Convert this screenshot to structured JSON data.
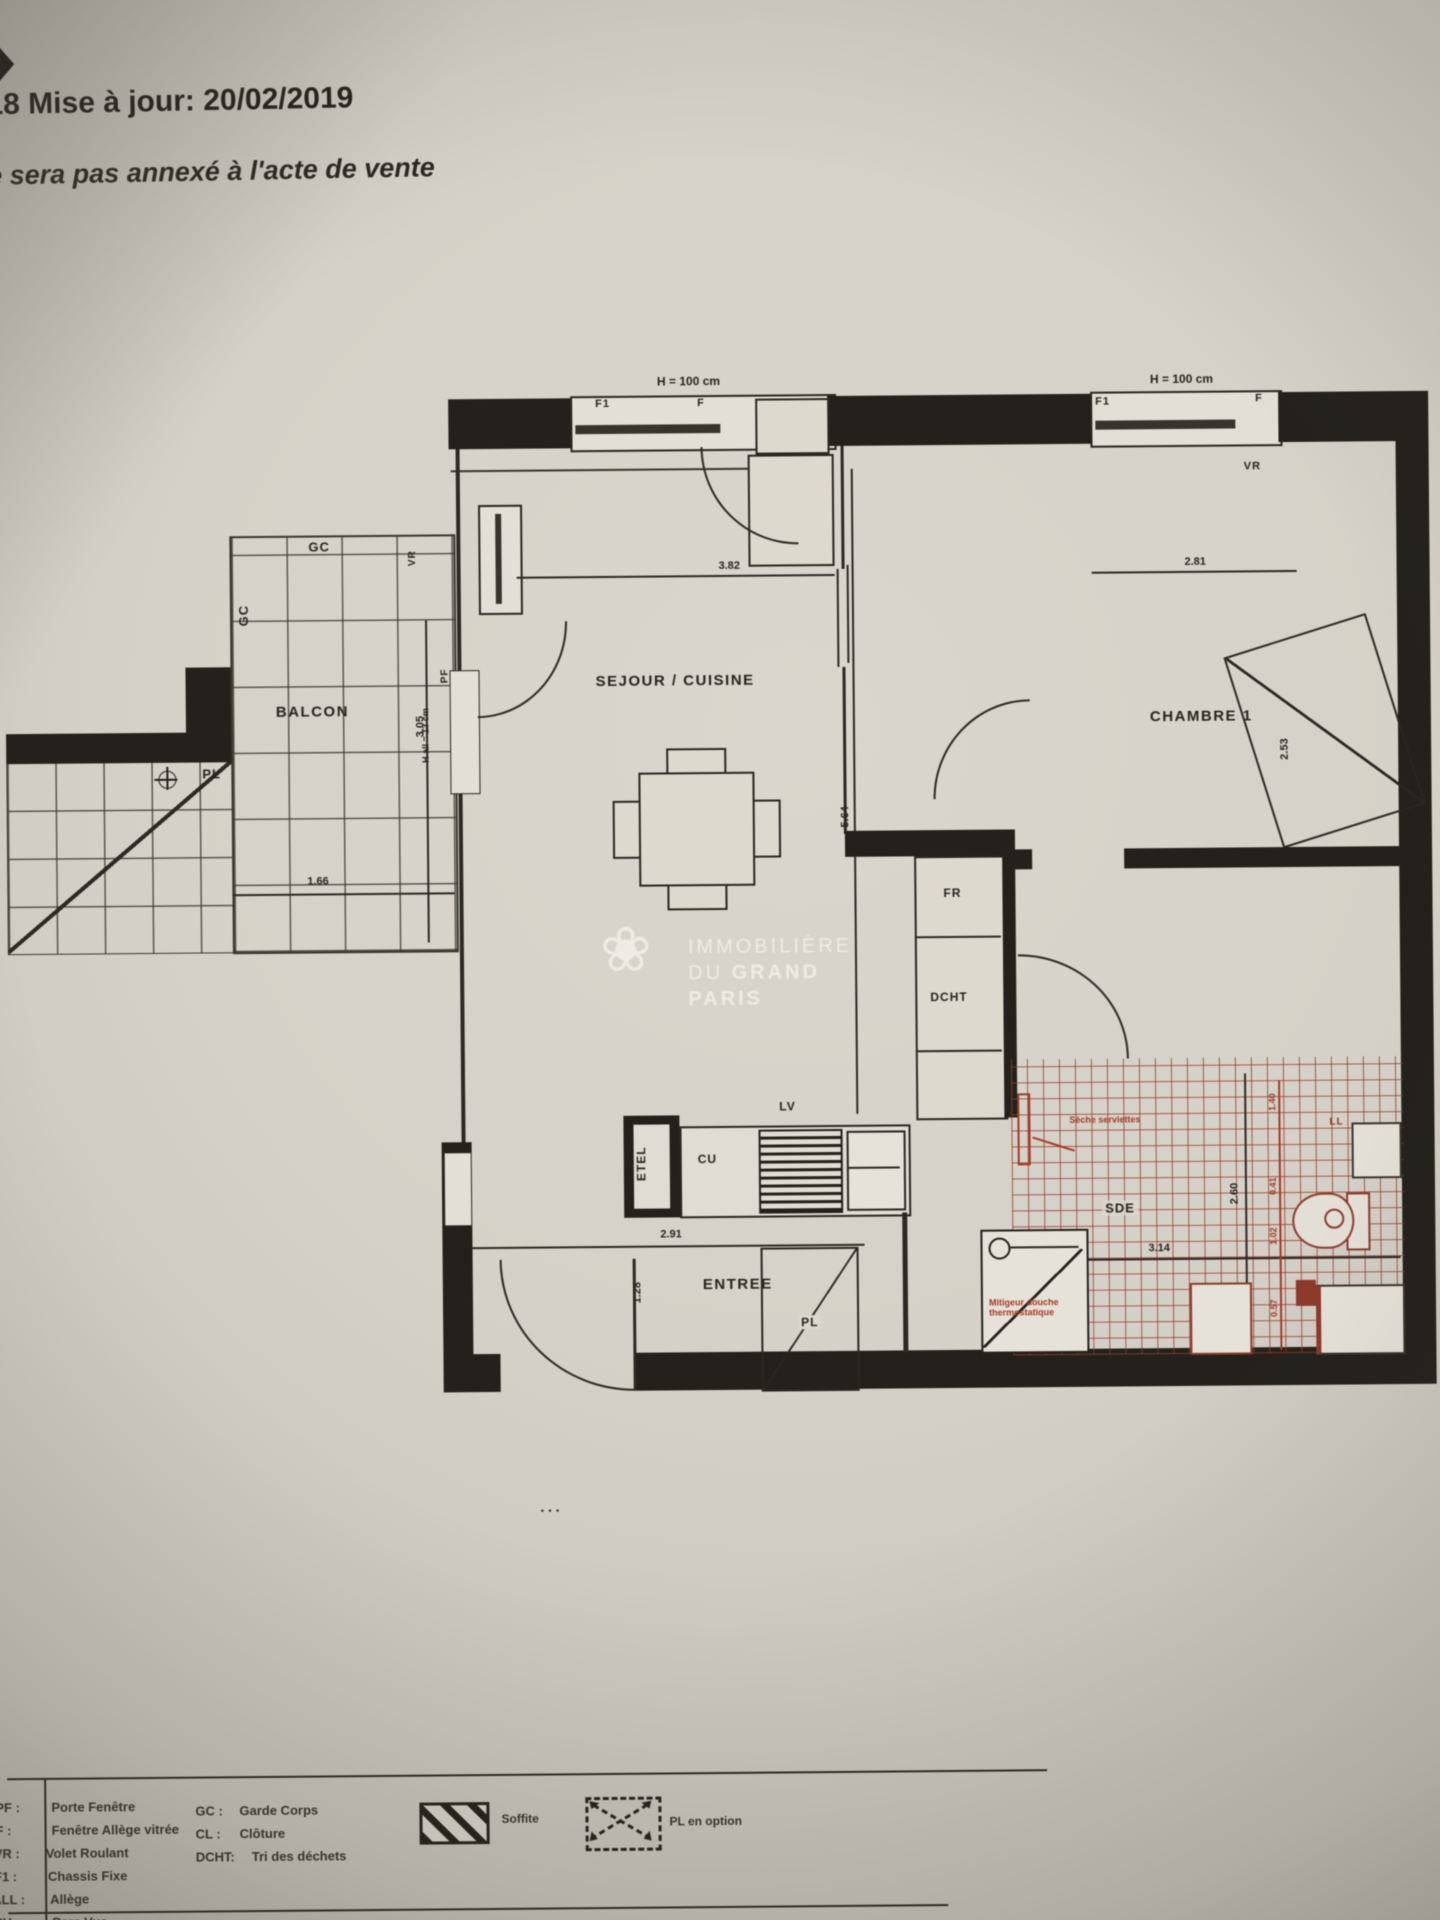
{
  "header": {
    "line1": "18 Mise à jour: 20/02/2019",
    "line2": "e sera pas annexé à l'acte de vente"
  },
  "watermark": {
    "flower": "❀",
    "line1": "IMMOBILIÈRE",
    "line2_pre": "DU",
    "line2_bold": "GRAND",
    "line3": "PARIS"
  },
  "plan": {
    "rooms": {
      "sejour": "SEJOUR / CUISINE",
      "chambre": "CHAMBRE 1",
      "balcon": "BALCON",
      "entree": "ENTREE",
      "sde": "SDE"
    },
    "labels": {
      "gc_top": "GC",
      "gc_left": "GC",
      "pl_terrace": "PL",
      "pl_entree": "PL",
      "f1_left": "F1",
      "f_left": "F",
      "f1_right": "F1",
      "f_right": "F",
      "vr_sejour": "VR",
      "vr_left": "VR",
      "vr_right": "VR",
      "pf": "PF",
      "h_left": "H = 100 cm",
      "h_right": "H = 100 cm",
      "h_allege": "H all = 13 cm",
      "fr": "FR",
      "dcht": "DCHT",
      "cu": "CU",
      "lv": "LV",
      "etel": "ETEL",
      "ll": "LL",
      "dots": "• • •"
    },
    "dimensions": {
      "sejour_w": "3.82",
      "chambre_w": "2.81",
      "balcon_h": "3.05",
      "balcon_w": "1.66",
      "sejour_h": "5.64",
      "entree_w": "2.91",
      "entree_h": "1.28",
      "sde_w": "3.14",
      "sde_h": "2.60",
      "chambre_d": "2.53",
      "red_chain": [
        "1.40",
        "0.41",
        "1.02",
        "0.57"
      ]
    },
    "red_notes": {
      "seche": "Sèche serviettes",
      "mitigeur": "Mitigeur douche thermostatique"
    }
  },
  "legend": {
    "left": [
      {
        "abbr": "PF :",
        "label": "Porte Fenêtre"
      },
      {
        "abbr": "F :",
        "label": "Fenêtre Allège vitrée"
      },
      {
        "abbr": "VR :",
        "label": "Volet Roulant"
      },
      {
        "abbr": "F1 :",
        "label": "Chassis Fixe"
      },
      {
        "abbr": "ALL :",
        "label": "Allège"
      },
      {
        "abbr": "PV :",
        "label": "Pare Vue"
      }
    ],
    "right": [
      {
        "abbr": "GC :",
        "label": "Garde Corps"
      },
      {
        "abbr": "CL :",
        "label": "Clôture"
      },
      {
        "abbr": "DCHT:",
        "label": "Tri des déchets"
      }
    ],
    "soffite": "Soffite",
    "pl_option": "PL en option"
  }
}
